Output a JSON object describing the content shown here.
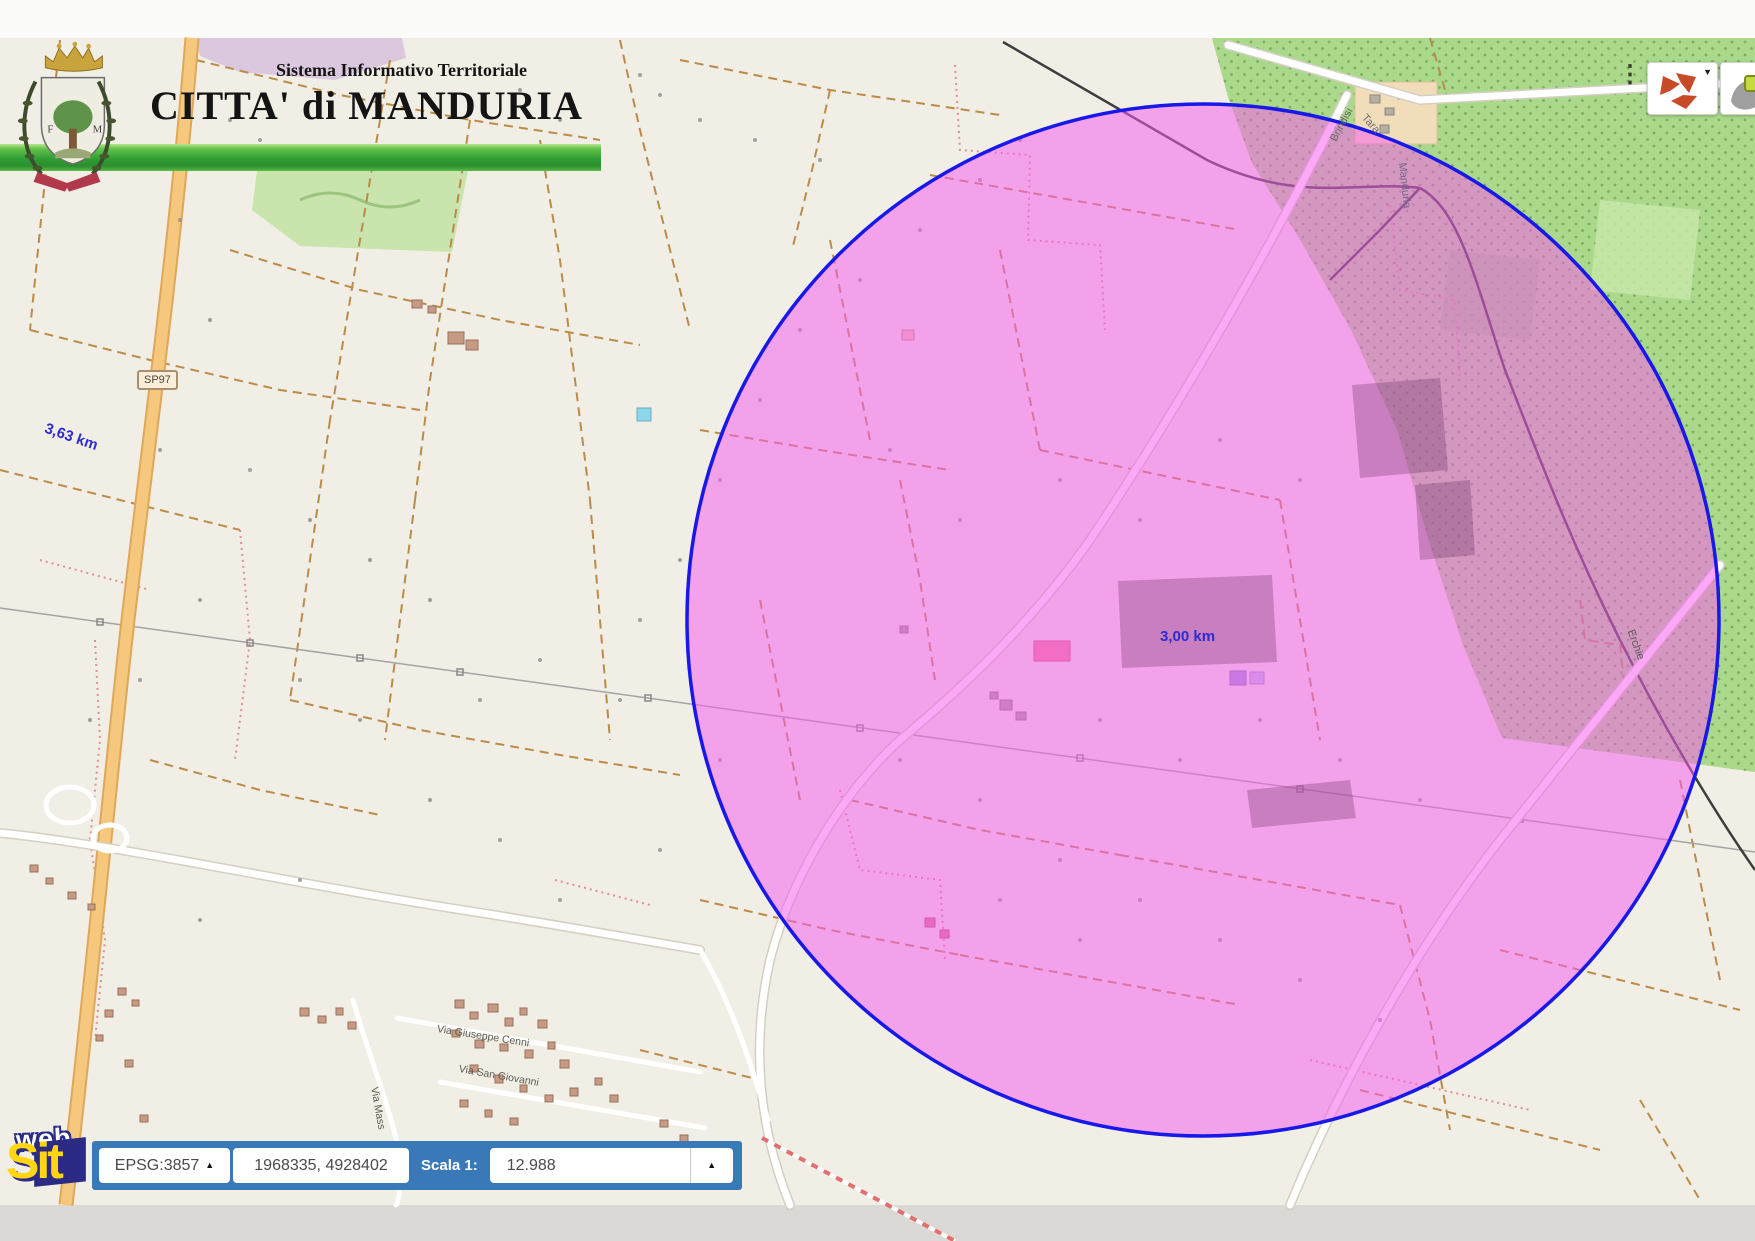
{
  "header": {
    "subtitle": "Sistema Informativo Territoriale",
    "title": "CITTA' di MANDURIA",
    "crest_initial_left": "F",
    "crest_initial_right": "M"
  },
  "map": {
    "road_ref_badge": "SP97",
    "segment_measure_label": "3,63 km",
    "circle_measure_label": "3,00 km",
    "street_labels": {
      "cenni": "Via Giuseppe Cenni",
      "san_giovanni": "Via San Giovanni",
      "massafra_partial": "Via Mass",
      "erchie": "Erchie",
      "brindisi": "Brindisi",
      "taranto_partial": "Tara",
      "manduria": "Manduria"
    },
    "colors": {
      "measure_circle_fill": "rgba(248,92,240,0.53)",
      "measure_circle_stroke": "#1818e8",
      "measure_text": "#2c2cd0",
      "toolbar_blue": "#3a79b8",
      "green_bar": "#2f9e33"
    }
  },
  "controls": {
    "icons": {
      "kebab": "⋮",
      "caret_up": "▲",
      "caret_down": "▼",
      "rotate_tool": "red-recycle-arrows",
      "street_tool": "gray-shape-yellow-pin"
    }
  },
  "toolbar": {
    "epsg_label": "EPSG:3857",
    "coordinates": "1968335, 4928402",
    "scale_prefix": "Scala 1:",
    "scale_value": "12.988"
  },
  "logo": {
    "line1": "web",
    "line2": "Sit"
  }
}
